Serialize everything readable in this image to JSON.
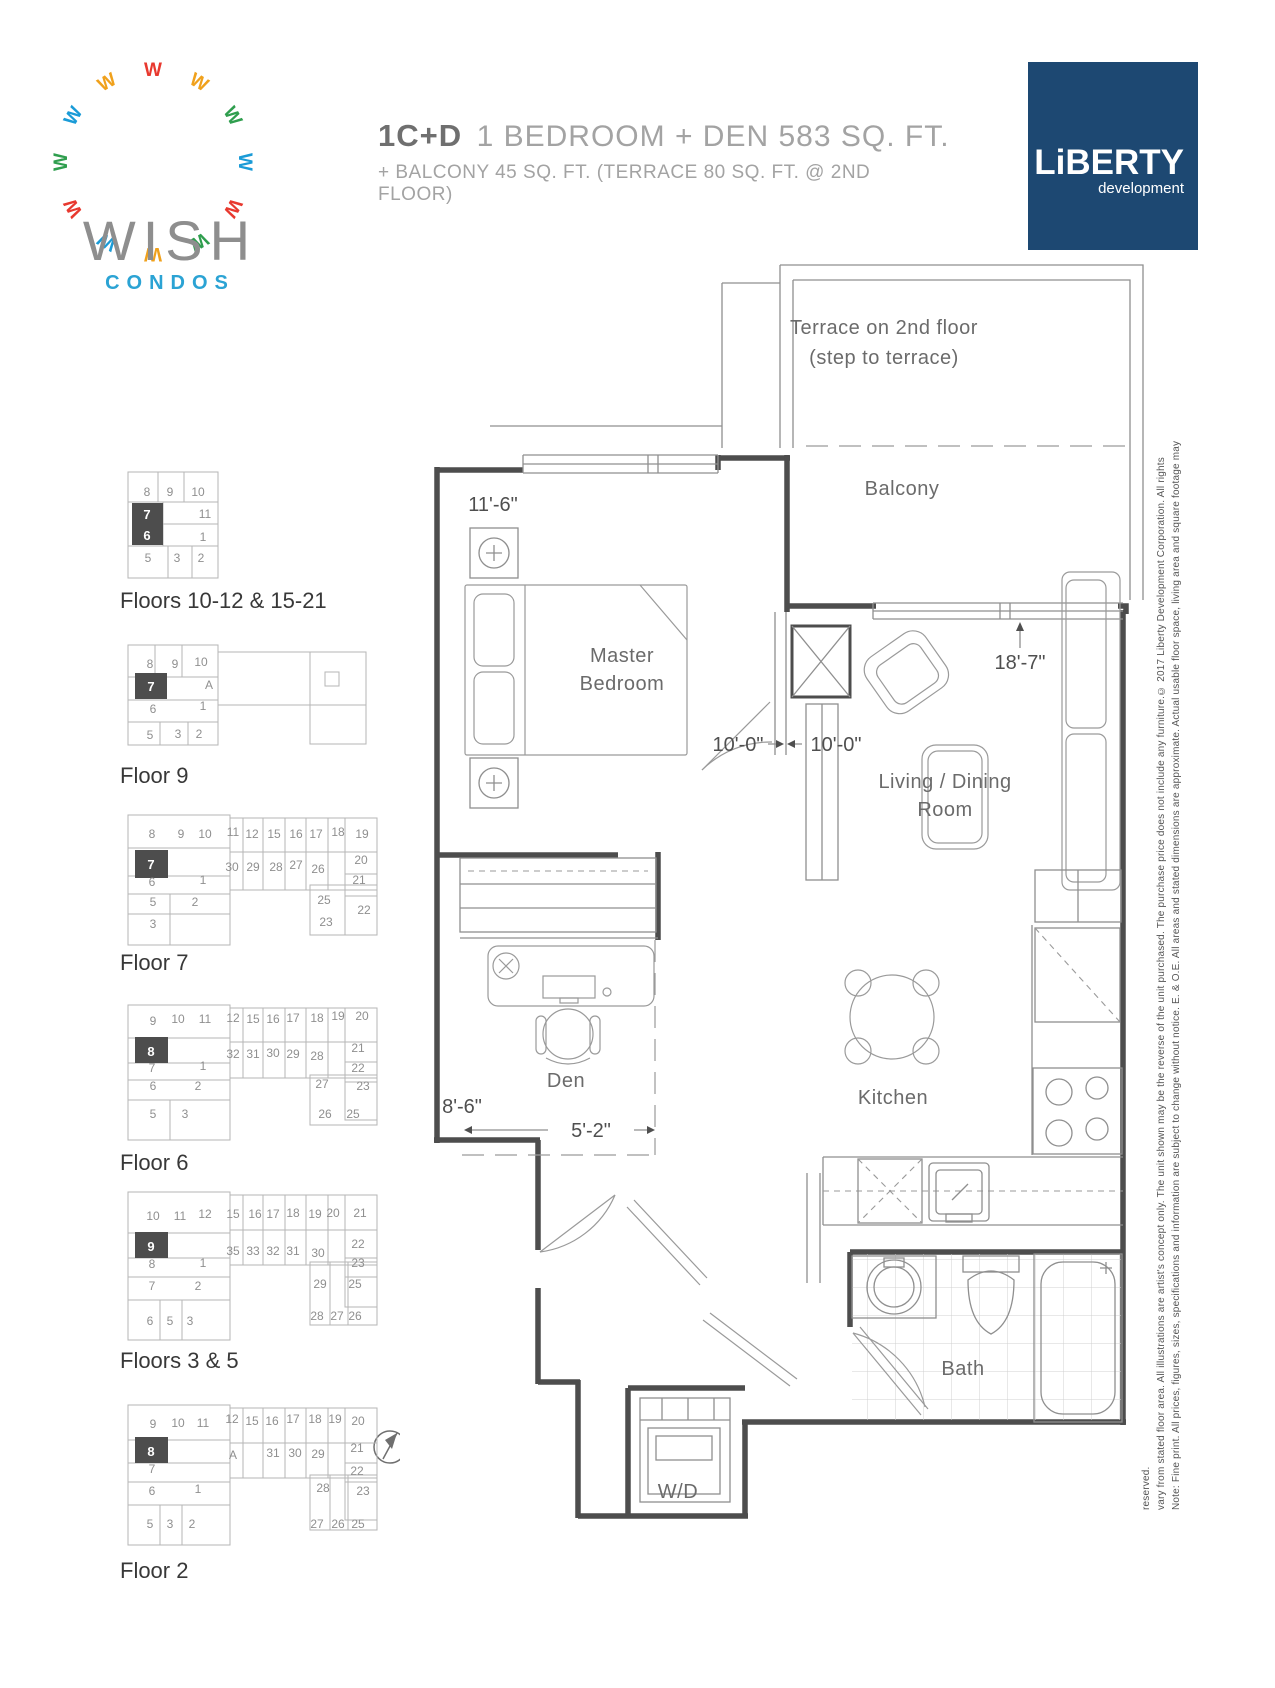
{
  "brand": {
    "name": "WISH",
    "tagline": "CONDOS",
    "logo_colors": [
      "#e8392f",
      "#f0a11c",
      "#2f9e4e",
      "#1a9bd7",
      "#e8392f",
      "#2f9e4e",
      "#f0a11c",
      "#1a9bd7",
      "#e8392f",
      "#2f9e4e",
      "#1a9bd7",
      "#f0a11c"
    ]
  },
  "header": {
    "unit_code": "1C+D",
    "unit_desc": "1 BEDROOM + DEN  583 SQ. FT.",
    "unit_sub": "+ BALCONY 45 SQ. FT. (TERRACE 80 SQ. FT. @ 2ND FLOOR)"
  },
  "developer": {
    "name": "LiBERTY",
    "sub": "development",
    "bg": "#1d4872"
  },
  "colors": {
    "accent_blue": "#2ba3d4",
    "dev_navy": "#1d4872",
    "wall": "#4d4d4d",
    "line": "#8f8f8f",
    "highlight": "#4d4d4d"
  },
  "plan_labels": {
    "terrace_line1": "Terrace on 2nd floor",
    "terrace_line2": "(step to terrace)",
    "balcony": "Balcony",
    "master_line1": "Master",
    "master_line2": "Bedroom",
    "living_line1": "Living / Dining",
    "living_line2": "Room",
    "den": "Den",
    "kitchen": "Kitchen",
    "bath": "Bath",
    "laundry": "W/D"
  },
  "dimensions": {
    "master_width": "11'-6\"",
    "hall_left": "10'-0\"",
    "hall_right": "10'-0\"",
    "living_length": "18'-7\"",
    "den_width": "5'-2\"",
    "den_depth": "8'-6\""
  },
  "key_plans": [
    {
      "id": "key-plan-floors-10-21",
      "label": "Floors 10-12 & 15-21",
      "label_x": 120,
      "label_y": 608,
      "rects": [
        [
          128,
          472,
          90,
          106
        ]
      ],
      "lines": [
        [
          128,
          502,
          218,
          502
        ],
        [
          128,
          546,
          218,
          546
        ],
        [
          158,
          472,
          158,
          502
        ],
        [
          184,
          472,
          184,
          502
        ],
        [
          163,
          502,
          163,
          546
        ],
        [
          163,
          524,
          218,
          524
        ],
        [
          168,
          546,
          168,
          578
        ],
        [
          192,
          546,
          192,
          578
        ]
      ],
      "highlight": [
        132,
        503,
        31,
        42
      ],
      "hl_units": [
        [
          "7",
          147,
          519
        ],
        [
          "6",
          147,
          540
        ]
      ],
      "units": [
        [
          "8",
          147,
          496
        ],
        [
          "9",
          170,
          496
        ],
        [
          "10",
          198,
          496
        ],
        [
          "11",
          205,
          518
        ],
        [
          "1",
          203,
          541
        ],
        [
          "5",
          148,
          562
        ],
        [
          "3",
          177,
          562
        ],
        [
          "2",
          201,
          562
        ]
      ]
    },
    {
      "id": "key-plan-floor-9",
      "label": "Floor 9",
      "label_x": 120,
      "label_y": 783,
      "rects": [
        [
          128,
          645,
          90,
          100
        ],
        [
          218,
          652,
          148,
          53
        ],
        [
          310,
          652,
          56,
          92
        ],
        [
          325,
          672,
          14,
          14
        ]
      ],
      "lines": [
        [
          128,
          677,
          218,
          677
        ],
        [
          128,
          700,
          218,
          700
        ],
        [
          155,
          645,
          155,
          677
        ],
        [
          182,
          645,
          182,
          677
        ],
        [
          128,
          722,
          218,
          722
        ],
        [
          160,
          722,
          160,
          745
        ],
        [
          188,
          722,
          188,
          745
        ]
      ],
      "highlight": [
        135,
        673,
        32,
        26
      ],
      "hl_units": [
        [
          "7",
          151,
          691
        ]
      ],
      "units": [
        [
          "8",
          150,
          668
        ],
        [
          "9",
          175,
          668
        ],
        [
          "10",
          201,
          666
        ],
        [
          "A",
          209,
          689
        ],
        [
          "6",
          153,
          713
        ],
        [
          "1",
          203,
          710
        ],
        [
          "5",
          150,
          739
        ],
        [
          "3",
          178,
          738
        ],
        [
          "2",
          199,
          738
        ]
      ]
    },
    {
      "id": "key-plan-floor-7",
      "label": "Floor 7",
      "label_x": 120,
      "label_y": 970,
      "rects": [
        [
          128,
          815,
          102,
          130
        ],
        [
          230,
          818,
          147,
          72
        ],
        [
          345,
          818,
          32,
          117
        ],
        [
          310,
          885,
          67,
          50
        ]
      ],
      "lines": [
        [
          230,
          852,
          377,
          852
        ],
        [
          243,
          818,
          243,
          890
        ],
        [
          263,
          818,
          263,
          890
        ],
        [
          285,
          818,
          285,
          890
        ],
        [
          306,
          818,
          306,
          890
        ],
        [
          328,
          818,
          328,
          890
        ],
        [
          128,
          848,
          230,
          848
        ],
        [
          128,
          876,
          230,
          876
        ],
        [
          128,
          894,
          230,
          894
        ],
        [
          128,
          914,
          230,
          914
        ],
        [
          170,
          894,
          170,
          945
        ],
        [
          345,
          874,
          377,
          874
        ],
        [
          345,
          896,
          377,
          896
        ]
      ],
      "highlight": [
        135,
        850,
        33,
        28
      ],
      "hl_units": [
        [
          "7",
          151,
          869
        ]
      ],
      "units": [
        [
          "8",
          152,
          838
        ],
        [
          "9",
          181,
          838
        ],
        [
          "10",
          205,
          838
        ],
        [
          "11",
          233,
          836
        ],
        [
          "12",
          252,
          838
        ],
        [
          "15",
          274,
          838
        ],
        [
          "16",
          296,
          838
        ],
        [
          "17",
          316,
          838
        ],
        [
          "18",
          338,
          836
        ],
        [
          "19",
          362,
          838
        ],
        [
          "30",
          232,
          871
        ],
        [
          "29",
          253,
          871
        ],
        [
          "28",
          276,
          871
        ],
        [
          "27",
          296,
          869
        ],
        [
          "26",
          318,
          873
        ],
        [
          "20",
          361,
          864
        ],
        [
          "6",
          152,
          886
        ],
        [
          "1",
          203,
          884
        ],
        [
          "21",
          359,
          884
        ],
        [
          "5",
          153,
          906
        ],
        [
          "2",
          195,
          906
        ],
        [
          "25",
          324,
          904
        ],
        [
          "22",
          364,
          914
        ],
        [
          "3",
          153,
          928
        ],
        [
          "23",
          326,
          926
        ]
      ]
    },
    {
      "id": "key-plan-floor-6",
      "label": "Floor 6",
      "label_x": 120,
      "label_y": 1170,
      "rects": [
        [
          128,
          1005,
          102,
          135
        ],
        [
          230,
          1008,
          147,
          70
        ],
        [
          345,
          1008,
          32,
          112
        ],
        [
          310,
          1075,
          67,
          50
        ]
      ],
      "lines": [
        [
          230,
          1042,
          377,
          1042
        ],
        [
          243,
          1008,
          243,
          1078
        ],
        [
          263,
          1008,
          263,
          1078
        ],
        [
          285,
          1008,
          285,
          1078
        ],
        [
          306,
          1008,
          306,
          1078
        ],
        [
          328,
          1008,
          328,
          1078
        ],
        [
          128,
          1038,
          230,
          1038
        ],
        [
          128,
          1063,
          230,
          1063
        ],
        [
          128,
          1080,
          230,
          1080
        ],
        [
          128,
          1100,
          230,
          1100
        ],
        [
          170,
          1100,
          170,
          1140
        ],
        [
          345,
          1062,
          377,
          1062
        ],
        [
          345,
          1082,
          377,
          1082
        ]
      ],
      "highlight": [
        135,
        1037,
        33,
        26
      ],
      "hl_units": [
        [
          "8",
          151,
          1056
        ]
      ],
      "units": [
        [
          "9",
          153,
          1025
        ],
        [
          "10",
          178,
          1023
        ],
        [
          "11",
          205,
          1023
        ],
        [
          "12",
          233,
          1022
        ],
        [
          "15",
          253,
          1023
        ],
        [
          "16",
          273,
          1023
        ],
        [
          "17",
          293,
          1022
        ],
        [
          "18",
          317,
          1022
        ],
        [
          "19",
          338,
          1020
        ],
        [
          "20",
          362,
          1020
        ],
        [
          "32",
          233,
          1058
        ],
        [
          "31",
          253,
          1058
        ],
        [
          "30",
          273,
          1057
        ],
        [
          "29",
          293,
          1058
        ],
        [
          "28",
          317,
          1060
        ],
        [
          "21",
          358,
          1052
        ],
        [
          "7",
          152,
          1072
        ],
        [
          "1",
          203,
          1070
        ],
        [
          "22",
          358,
          1072
        ],
        [
          "6",
          153,
          1090
        ],
        [
          "2",
          198,
          1090
        ],
        [
          "27",
          322,
          1088
        ],
        [
          "23",
          363,
          1090
        ],
        [
          "5",
          153,
          1118
        ],
        [
          "3",
          185,
          1118
        ],
        [
          "26",
          325,
          1118
        ],
        [
          "25",
          353,
          1118
        ]
      ]
    },
    {
      "id": "key-plan-floors-3-5",
      "label": "Floors 3 & 5",
      "label_x": 120,
      "label_y": 1368,
      "rects": [
        [
          128,
          1192,
          102,
          148
        ],
        [
          230,
          1195,
          147,
          70
        ],
        [
          345,
          1195,
          32,
          112
        ],
        [
          310,
          1262,
          67,
          63
        ]
      ],
      "lines": [
        [
          230,
          1230,
          377,
          1230
        ],
        [
          243,
          1195,
          243,
          1265
        ],
        [
          263,
          1195,
          263,
          1265
        ],
        [
          285,
          1195,
          285,
          1265
        ],
        [
          306,
          1195,
          306,
          1265
        ],
        [
          328,
          1195,
          328,
          1265
        ],
        [
          128,
          1233,
          230,
          1233
        ],
        [
          128,
          1258,
          230,
          1258
        ],
        [
          128,
          1277,
          230,
          1277
        ],
        [
          128,
          1300,
          230,
          1300
        ],
        [
          160,
          1300,
          160,
          1340
        ],
        [
          182,
          1300,
          182,
          1340
        ],
        [
          345,
          1258,
          377,
          1258
        ],
        [
          345,
          1277,
          377,
          1277
        ],
        [
          330,
          1262,
          330,
          1325
        ],
        [
          348,
          1262,
          348,
          1325
        ]
      ],
      "highlight": [
        135,
        1232,
        33,
        26
      ],
      "hl_units": [
        [
          "9",
          151,
          1251
        ]
      ],
      "units": [
        [
          "10",
          153,
          1220
        ],
        [
          "11",
          180,
          1220
        ],
        [
          "12",
          205,
          1218
        ],
        [
          "15",
          233,
          1218
        ],
        [
          "16",
          255,
          1218
        ],
        [
          "17",
          273,
          1218
        ],
        [
          "18",
          293,
          1217
        ],
        [
          "19",
          315,
          1218
        ],
        [
          "20",
          333,
          1217
        ],
        [
          "21",
          360,
          1217
        ],
        [
          "35",
          233,
          1255
        ],
        [
          "33",
          253,
          1255
        ],
        [
          "32",
          273,
          1255
        ],
        [
          "31",
          293,
          1255
        ],
        [
          "30",
          318,
          1257
        ],
        [
          "22",
          358,
          1248
        ],
        [
          "8",
          152,
          1268
        ],
        [
          "1",
          203,
          1267
        ],
        [
          "23",
          358,
          1267
        ],
        [
          "7",
          152,
          1290
        ],
        [
          "2",
          198,
          1290
        ],
        [
          "29",
          320,
          1288
        ],
        [
          "25",
          355,
          1288
        ],
        [
          "6",
          150,
          1325
        ],
        [
          "5",
          170,
          1325
        ],
        [
          "3",
          190,
          1325
        ],
        [
          "28",
          317,
          1320
        ],
        [
          "27",
          337,
          1320
        ],
        [
          "26",
          355,
          1320
        ]
      ]
    },
    {
      "id": "key-plan-floor-2",
      "label": "Floor 2",
      "label_x": 120,
      "label_y": 1578,
      "rects": [
        [
          128,
          1405,
          102,
          140
        ],
        [
          230,
          1408,
          147,
          70
        ],
        [
          345,
          1408,
          32,
          112
        ],
        [
          310,
          1475,
          67,
          55
        ]
      ],
      "lines": [
        [
          230,
          1443,
          377,
          1443
        ],
        [
          243,
          1408,
          243,
          1478
        ],
        [
          263,
          1408,
          263,
          1478
        ],
        [
          285,
          1408,
          285,
          1478
        ],
        [
          306,
          1408,
          306,
          1478
        ],
        [
          328,
          1408,
          328,
          1478
        ],
        [
          128,
          1440,
          230,
          1440
        ],
        [
          128,
          1463,
          230,
          1463
        ],
        [
          128,
          1482,
          230,
          1482
        ],
        [
          128,
          1505,
          230,
          1505
        ],
        [
          160,
          1505,
          160,
          1545
        ],
        [
          182,
          1505,
          182,
          1545
        ],
        [
          345,
          1463,
          377,
          1463
        ],
        [
          345,
          1482,
          377,
          1482
        ],
        [
          330,
          1475,
          330,
          1530
        ],
        [
          348,
          1475,
          348,
          1530
        ]
      ],
      "highlight": [
        135,
        1437,
        33,
        26
      ],
      "hl_units": [
        [
          "8",
          151,
          1456
        ]
      ],
      "units": [
        [
          "9",
          153,
          1428
        ],
        [
          "10",
          178,
          1427
        ],
        [
          "11",
          203,
          1427
        ],
        [
          "12",
          232,
          1423
        ],
        [
          "15",
          252,
          1425
        ],
        [
          "16",
          272,
          1425
        ],
        [
          "17",
          293,
          1423
        ],
        [
          "18",
          315,
          1423
        ],
        [
          "19",
          335,
          1423
        ],
        [
          "20",
          358,
          1425
        ],
        [
          "A",
          233,
          1459
        ],
        [
          "31",
          273,
          1457
        ],
        [
          "30",
          295,
          1457
        ],
        [
          "29",
          318,
          1458
        ],
        [
          "21",
          357,
          1452
        ],
        [
          "7",
          152,
          1473
        ],
        [
          "22",
          357,
          1475
        ],
        [
          "6",
          152,
          1495
        ],
        [
          "1",
          198,
          1493
        ],
        [
          "28",
          323,
          1492
        ],
        [
          "23",
          363,
          1495
        ],
        [
          "5",
          150,
          1528
        ],
        [
          "3",
          170,
          1528
        ],
        [
          "2",
          192,
          1528
        ],
        [
          "27",
          317,
          1528
        ],
        [
          "26",
          338,
          1528
        ],
        [
          "25",
          358,
          1528
        ]
      ]
    }
  ],
  "disclaimer": "Note: Fine print. All prices, figures, sizes, specifications and information are subject to change without notice. E. & O.E. All areas and stated dimensions are approximate. Actual usable floor space, living area and square footage may vary from stated floor area. All illustrations are artist's concept only. The unit shown may be the reverse of the unit purchased. The purchase price does not include any furniture.© 2017 Liberty Development Corporation. All rights reserved."
}
